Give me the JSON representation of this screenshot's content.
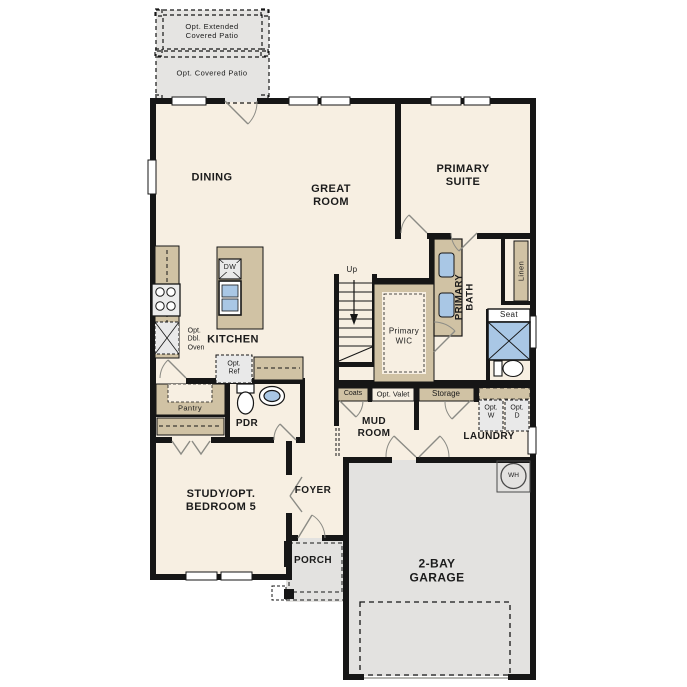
{
  "plan": {
    "patio": {
      "extended": "Opt. Extended\nCovered Patio",
      "covered": "Opt. Covered Patio"
    },
    "rooms": {
      "dining": "DINING",
      "great_room": "GREAT\nROOM",
      "primary_suite": "PRIMARY\nSUITE",
      "kitchen": "KITCHEN",
      "primary_wic": "Primary\nWIC",
      "primary_bath": "PRIMARY\nBATH",
      "pdr": "PDR",
      "pantry": "Pantry",
      "mud_room": "MUD\nROOM",
      "laundry": "LAUNDRY",
      "study": "STUDY/OPT.\nBEDROOM 5",
      "foyer": "FOYER",
      "porch": "PORCH",
      "garage": "2-BAY\nGARAGE"
    },
    "features": {
      "linen": "Linen",
      "seat": "Seat",
      "coats": "Coats",
      "opt_valet": "Opt. Valet",
      "storage": "Storage",
      "opt_washer": "Opt.\nW",
      "opt_dryer": "Opt.\nD",
      "opt_ref": "Opt.\nRef",
      "dishwasher": "DW",
      "opt_dbl_oven": "Opt.\nDbl.\nOven",
      "stairs_up": "Up",
      "water_heater": "WH"
    },
    "colors": {
      "wall": "#161616",
      "interior": "#f7efe2",
      "patio_gray": "#e5e4e2",
      "garage_gray": "#e3e2e0",
      "cabinet_tan": "#d0c2a4",
      "fixture_blue": "#a9c7e5",
      "appliance_gray": "#e9e9e9",
      "door_stroke": "#8b8b85"
    }
  }
}
